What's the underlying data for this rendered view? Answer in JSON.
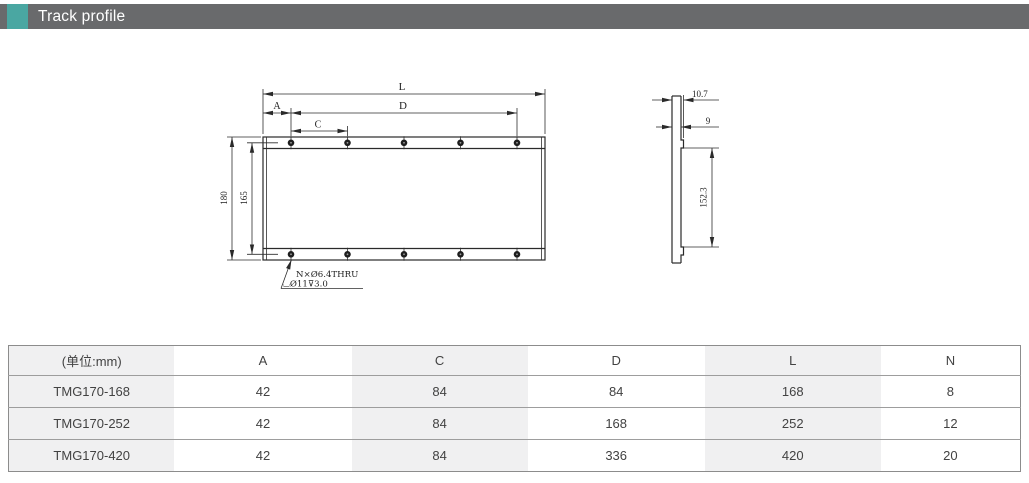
{
  "header": {
    "title": "Track profile"
  },
  "colors": {
    "accent": "#4aa7a2",
    "header_bar": "#696a6c"
  },
  "drawing": {
    "front_view": {
      "length_label": "L",
      "hole_span_label": "D",
      "edge_offset_label": "A",
      "hole_pitch_label": "C",
      "overall_height": "180",
      "hole_row_spacing": "165",
      "hole_note_line1": "N×Ø6.4THRU",
      "hole_note_line2": "⌴Ø11⊽3.0"
    },
    "side_view": {
      "overall_width": "10.7",
      "plate_thickness": "9",
      "inner_height": "152.3"
    }
  },
  "table": {
    "unit_header": "(单位:mm)",
    "columns": [
      "(单位:mm)",
      "A",
      "C",
      "D",
      "L",
      "N"
    ],
    "rows": [
      [
        "TMG170-168",
        "42",
        "84",
        "84",
        "168",
        "8"
      ],
      [
        "TMG170-252",
        "42",
        "84",
        "168",
        "252",
        "12"
      ],
      [
        "TMG170-420",
        "42",
        "84",
        "336",
        "420",
        "20"
      ]
    ]
  }
}
